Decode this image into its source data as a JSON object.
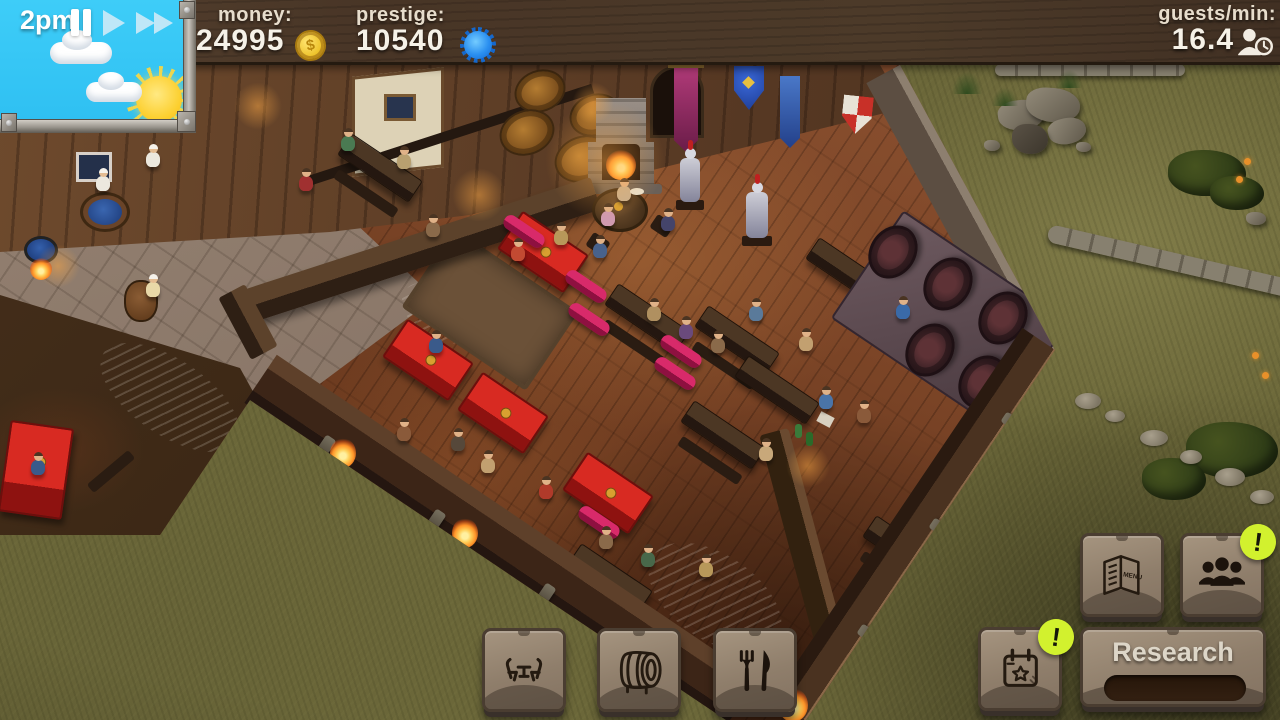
{
  "hud": {
    "time": "2pm",
    "money": {
      "label": "money:",
      "value": "24995",
      "coin_symbol": "$"
    },
    "prestige": {
      "label": "prestige:",
      "value": "10540"
    },
    "guests_per_min": {
      "label": "guests/min:",
      "value": "16.4"
    }
  },
  "toolbar_build": {
    "furniture_icon": "table-chairs-icon",
    "drinks_icon": "barrel-icon",
    "food_icon": "fork-knife-icon"
  },
  "toolbar_management": {
    "menu": {
      "icon": "menu-book-icon",
      "book_label": "MENU"
    },
    "staff": {
      "icon": "staff-people-icon",
      "notification": "!"
    },
    "events": {
      "icon": "calendar-star-icon",
      "notification": "!"
    },
    "research": {
      "label": "Research",
      "progress_percent": 0
    }
  },
  "colors": {
    "sky": "#35c8f5",
    "top_bar_wood": "#4a3727",
    "coin_gold": "#f0c030",
    "prestige_blue": "#1e86e8",
    "notification_green": "#d2f12e",
    "plaque_face": "#92826f",
    "tablecloth_red": "#c62421",
    "cushion_magenta": "#cc2368",
    "grass_olive": "#6b673a"
  }
}
